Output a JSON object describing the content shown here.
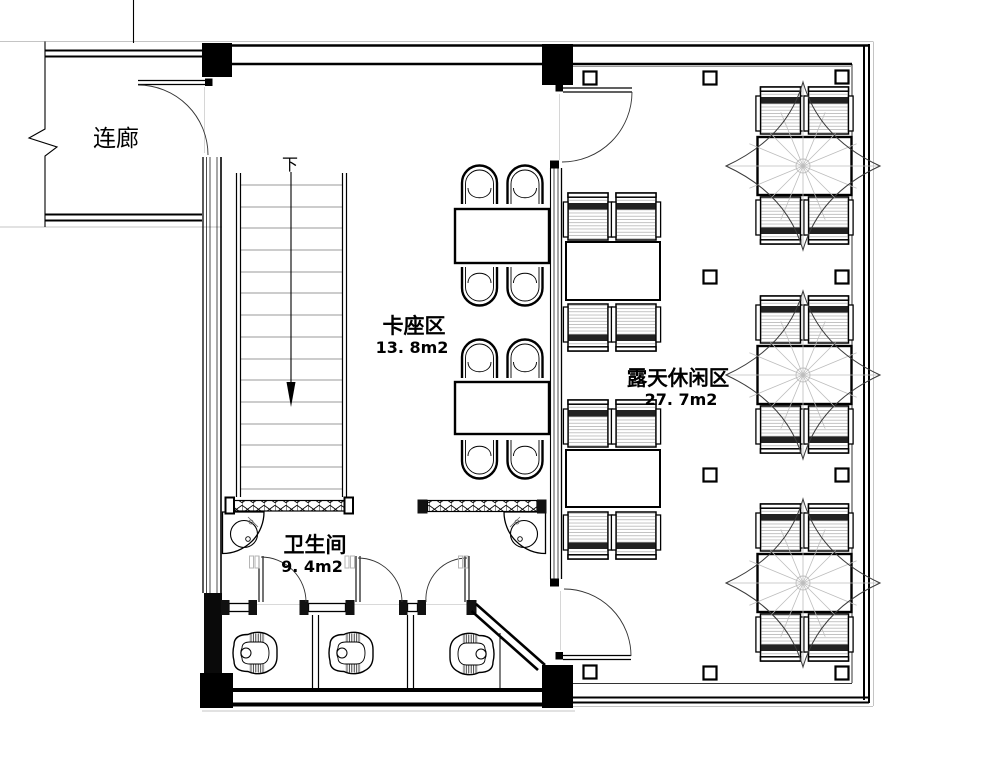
{
  "plan": {
    "labels": {
      "corridor": "连廊",
      "stairs_down": "下",
      "booth": {
        "name": "卡座区",
        "area": "13. 8m2"
      },
      "outdoor": {
        "name": "露天休闲区",
        "area": "27. 7m2"
      },
      "restroom": {
        "name": "卫生间",
        "area": "9. 4m2"
      }
    },
    "colors": {
      "wall": "#000000",
      "line_medium": "#444444",
      "line_light": "#c4c4c4",
      "background": "#ffffff"
    }
  }
}
